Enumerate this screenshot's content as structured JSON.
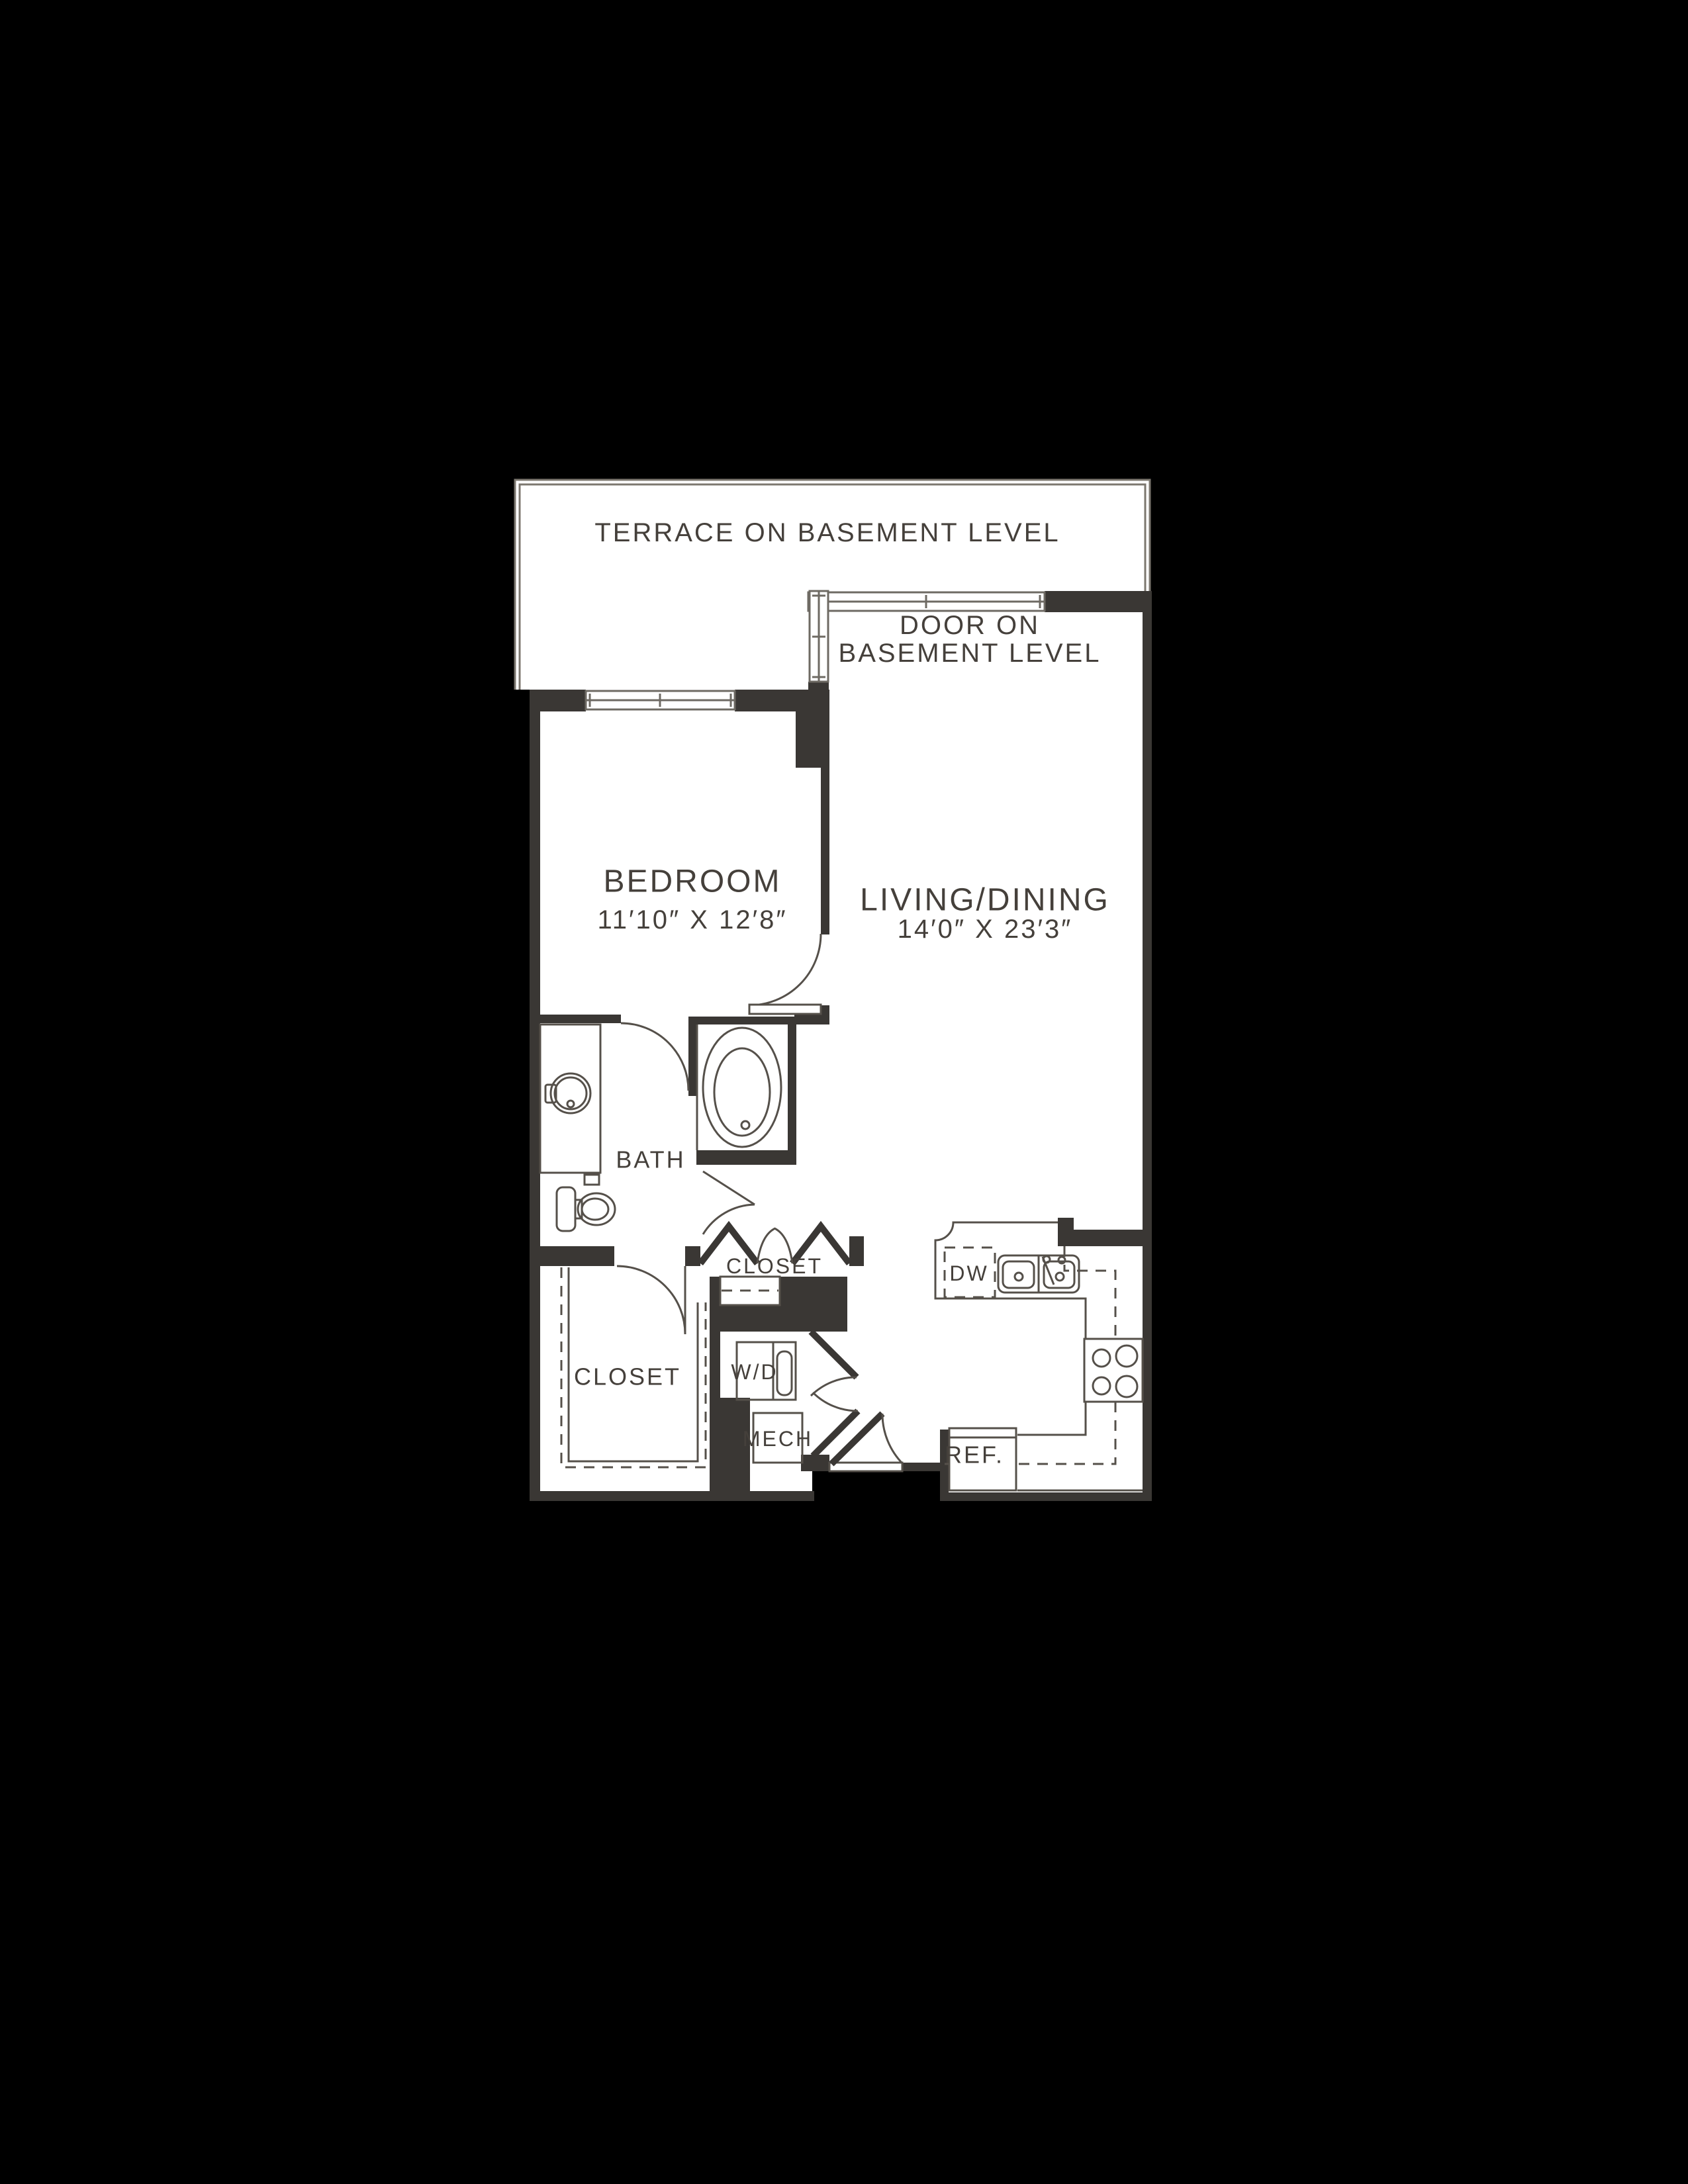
{
  "page": {
    "background": "#000000"
  },
  "colors": {
    "wall": "#3a3734",
    "fixture_line": "#55504a",
    "terrace_line": "#7c776f",
    "text": "#45403b",
    "floor": "#ffffff",
    "background": "#000000"
  },
  "rooms": {
    "terrace_label": "TERRACE ON BASEMENT LEVEL",
    "basement_door_line1": "DOOR ON",
    "basement_door_line2": "BASEMENT LEVEL",
    "bedroom_label": "BEDROOM",
    "bedroom_dims": "11′10″ X 12′8″",
    "living_label": "LIVING/DINING",
    "living_dims": "14′0″ X 23′3″",
    "bath_label": "BATH",
    "hall_closet_label": "CLOSET",
    "walkin_closet_label": "CLOSET"
  },
  "fixtures": {
    "washer_dryer": "W/D",
    "mechanical": "MECH",
    "dishwasher": "DW",
    "refrigerator": "REF."
  }
}
